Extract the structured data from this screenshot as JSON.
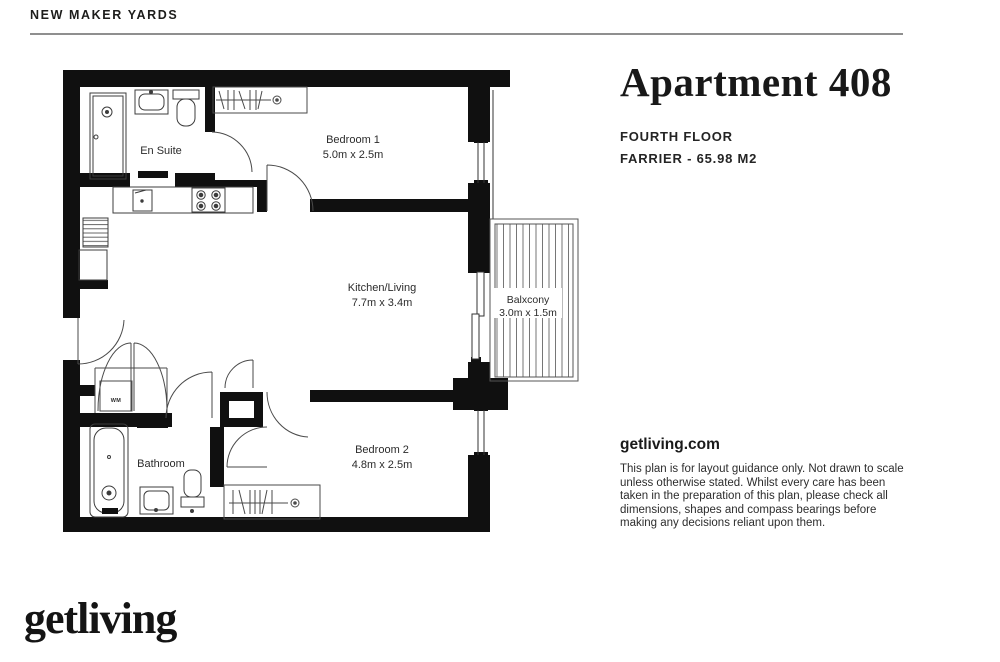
{
  "header": {
    "project_name": "NEW MAKER YARDS"
  },
  "title_block": {
    "apartment_title": "Apartment 408",
    "floor_label": "FOURTH FLOOR",
    "type_area_label": "FARRIER - 65.98 M2",
    "website": "getliving.com",
    "disclaimer": "This plan is for layout guidance only. Not drawn to scale unless otherwise stated. Whilst every care has been taken in the preparation of this plan, please check all dimensions, shapes and compass bearings before making any decisions reliant upon them."
  },
  "floor_plan": {
    "rooms": [
      {
        "name": "En Suite",
        "dimensions": ""
      },
      {
        "name": "Bedroom 1",
        "dimensions": "5.0m x 2.5m"
      },
      {
        "name": "Kitchen/Living",
        "dimensions": "7.7m x 3.4m"
      },
      {
        "name": "Balxcony",
        "dimensions": "3.0m x 1.5m"
      },
      {
        "name": "Bathroom",
        "dimensions": ""
      },
      {
        "name": "Bedroom 2",
        "dimensions": "4.8m x 2.5m"
      },
      {
        "name": "WM",
        "dimensions": ""
      }
    ]
  },
  "footer": {
    "logo_text": "getliving"
  },
  "colors": {
    "wall": "#101010",
    "line": "#3c3c3c",
    "accent_text": "#1d1d1b"
  }
}
